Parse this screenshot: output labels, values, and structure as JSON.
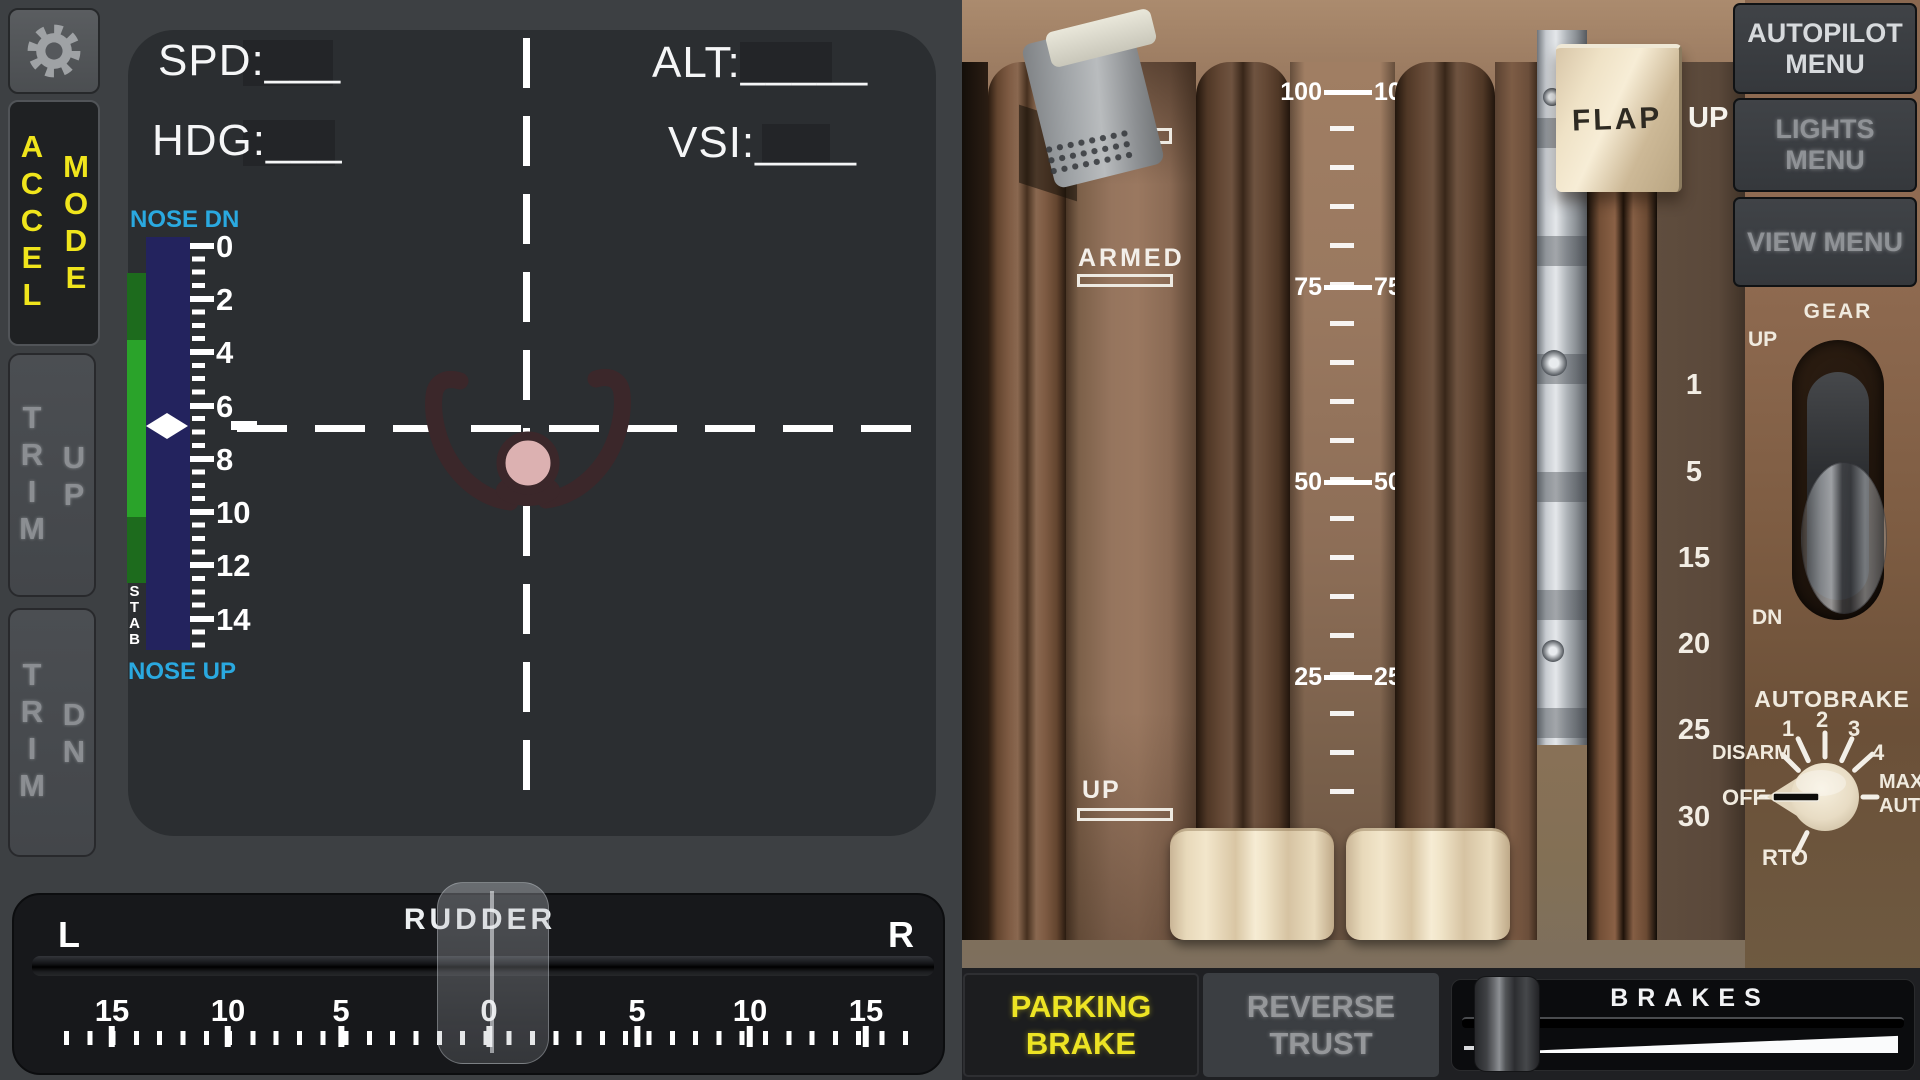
{
  "left": {
    "accel_mode": {
      "accel": "ACCEL",
      "mode": "MODE"
    },
    "trim_up": {
      "word": "TRIM",
      "dir": "UP"
    },
    "trim_dn": {
      "word": "TRIM",
      "dir": "DN"
    },
    "hud": {
      "spd": "SPD:___",
      "hdg": "HDG:___",
      "alt": "ALT:_____",
      "vsi": "VSI:____"
    },
    "trim": {
      "top": "NOSE DN",
      "bottom": "NOSE UP",
      "stab": "STAB",
      "ticks": [
        "0",
        "2",
        "4",
        "6",
        "8",
        "10",
        "12",
        "14"
      ],
      "indicator_value": 6.8
    },
    "rudder": {
      "title": "RUDDER",
      "l": "L",
      "r": "R",
      "ticks": [
        "15",
        "10",
        "5",
        "0",
        "5",
        "10",
        "15"
      ],
      "position": 0
    }
  },
  "right": {
    "speedbrake": {
      "armed": "ARMED",
      "up": "UP"
    },
    "thrust_ticks": [
      "100",
      "75",
      "50",
      "25"
    ],
    "flap": {
      "label": "FLAP",
      "position": "UP",
      "detents": [
        "1",
        "5",
        "15",
        "20",
        "25",
        "30"
      ]
    },
    "menus": {
      "autopilot": "AUTOPILOT MENU",
      "lights": "LIGHTS MENU",
      "view": "VIEW MENU"
    },
    "gear": {
      "title": "GEAR",
      "up": "UP",
      "dn": "DN"
    },
    "autobrake": {
      "title": "AUTOBRAKE",
      "disarm": "DISARM",
      "n1": "1",
      "n2": "2",
      "n3": "3",
      "n4": "4",
      "max": "MAX AUTO",
      "off": "OFF",
      "rto": "RTO",
      "selected": "OFF"
    }
  },
  "bottom": {
    "parking": "PARKING BRAKE",
    "reverse": "REVERSE TRUST",
    "brakes": "BRAKES"
  },
  "colors": {
    "accent_yellow": "#f0e51c",
    "cyan": "#2aa9e0",
    "trim_green": "#2aa32a",
    "trim_navy": "#23235e",
    "panel_dark": "#2b2e31",
    "wood_brown": "#8a6850"
  }
}
